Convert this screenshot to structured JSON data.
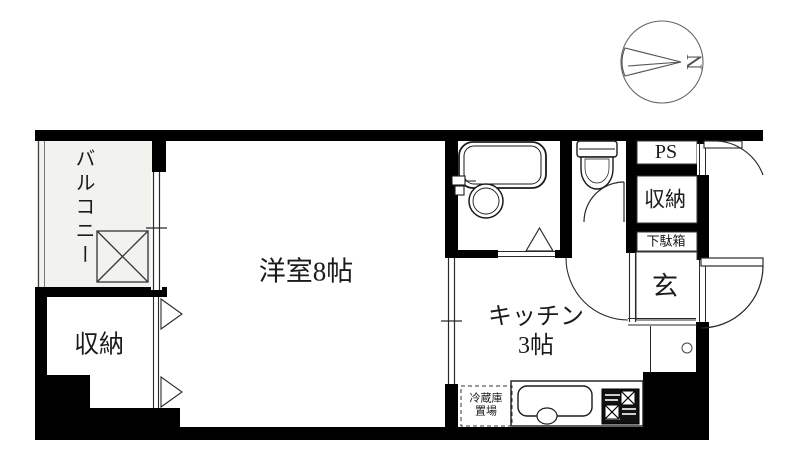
{
  "compass": {
    "north_letter": "N"
  },
  "rooms": {
    "balcony": {
      "label": "バルコニー"
    },
    "western_room": {
      "label": "洋室8帖"
    },
    "closet_left": {
      "label": "収納"
    },
    "kitchen": {
      "label": "キッチン",
      "size_label": "3帖"
    },
    "pipe_space": {
      "label": "PS"
    },
    "closet_right": {
      "label": "収納"
    },
    "shoe_cabinet": {
      "label": "下駄箱"
    },
    "entrance": {
      "label": "玄"
    },
    "refrigerator_space": {
      "line1": "冷蔵庫",
      "line2": "置場"
    }
  },
  "colors": {
    "wall": "#000000",
    "line": "#2a2a2a",
    "balcony_fill": "#f2f2ef",
    "background": "#ffffff"
  }
}
